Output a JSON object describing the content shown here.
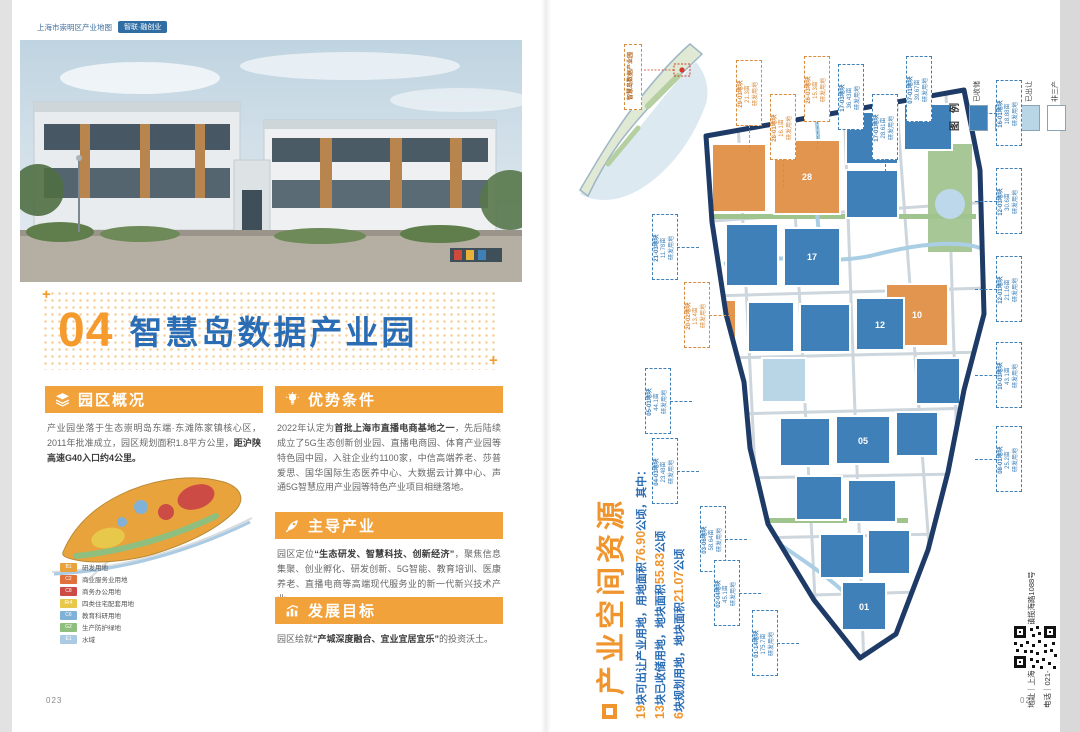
{
  "header": {
    "doc_title": "上海市崇明区产业地图",
    "tag": "智联·融创业"
  },
  "page_title": {
    "number": "04",
    "text": "智慧岛数据产业园"
  },
  "sections": {
    "overview": {
      "heading": "园区概况",
      "body_1": "产业园坐落于生态崇明岛东端·东滩陈家镇核心区，2011年批准成立，园区规划面积1.8平方公里，",
      "body_bold": "距沪陕高速G40入口约4公里。"
    },
    "advantages": {
      "heading": "优势条件",
      "body_1": "2022年认定为",
      "body_bold": "首批上海市直播电商基地之一",
      "body_2": "，先后陆续成立了5G生态创新创业园、直播电商园、体育产业园等特色园中园，入驻企业约1100家，中信高端养老、莎普爱思、国华国际生态医养中心、大数据云计算中心、声通5G智慧应用产业园等特色产业项目相继落地。"
    },
    "industries": {
      "heading": "主导产业",
      "body_1": "园区定位",
      "body_bold": "“生态研发、智慧科技、创新经济”",
      "body_2": "，聚焦信息集聚、创业孵化、研发创新、5G智能、教育培训、医康养老、直播电商等高端现代服务业的新一代新兴技术产业。"
    },
    "goals": {
      "heading": "发展目标",
      "body_1": "园区绘就",
      "body_bold": "“产城深度融合、宜业宜居宜乐”",
      "body_2": "的投资沃土。"
    }
  },
  "zoning_legend": {
    "items": [
      {
        "code": "B1",
        "label": "研发用地",
        "color": "#e8a33d"
      },
      {
        "code": "C2",
        "label": "商业服务业用地",
        "color": "#e2703a"
      },
      {
        "code": "C8",
        "label": "商务办公用地",
        "color": "#cc4b44"
      },
      {
        "code": "Rr4",
        "label": "四类住宅配套用地",
        "color": "#e8c84a"
      },
      {
        "code": "C6",
        "label": "教育科研用地",
        "color": "#7fb2d6"
      },
      {
        "code": "G2",
        "label": "生产防护绿地",
        "color": "#8fbf7f"
      },
      {
        "code": "E1",
        "label": "水域",
        "color": "#aacbe3"
      }
    ]
  },
  "right_page": {
    "vertical_title": "产业空间资源",
    "stats": [
      {
        "n1": "19",
        "t1": "块可出让产业用地，用地面积",
        "n2": "76.90",
        "t2": "公顷，其中："
      },
      {
        "n1": "13",
        "t1": "块已收储用地，地块面积",
        "n2": "55.83",
        "t2": "公顷"
      },
      {
        "n1": "6",
        "t1": "块规划用地，地块面积",
        "n2": "21.07",
        "t2": "公顷"
      }
    ],
    "map_legend": {
      "title": "图例",
      "items": [
        {
          "label": "已收储",
          "color": "#3f80b8"
        },
        {
          "label": "规划",
          "color": "#e2954e"
        },
        {
          "label": "已出让",
          "color": "#b9d6e6"
        },
        {
          "label": "非三产",
          "color": "#ffffff"
        }
      ]
    },
    "inset_label": "智慧岛数据产业园",
    "contact": {
      "address": "地址｜上海市崇明区陈家镇揽海路1088号",
      "phone": "电话｜021-59470082"
    },
    "callouts": [
      {
        "code": "29-03地块",
        "area": "21.3亩",
        "use": "研发用地"
      },
      {
        "code": "28-01地块",
        "area": "16.1亩",
        "use": "研发用地"
      },
      {
        "code": "26-03地块",
        "area": "15.3亩",
        "use": "研发用地"
      },
      {
        "code": "17-03地块",
        "area": "36.43亩",
        "use": "研发用地"
      },
      {
        "code": "17-01地块",
        "area": "28.61亩",
        "use": "研发用地"
      },
      {
        "code": "07-01地块",
        "area": "39.67亩",
        "use": "研发用地"
      },
      {
        "code": "16-01地块",
        "area": "18.88亩",
        "use": "研发用地"
      },
      {
        "code": "12-03地块",
        "area": "30.6亩",
        "use": "研发用地"
      },
      {
        "code": "12-01地块",
        "area": "21.16亩",
        "use": "研发用地"
      },
      {
        "code": "10-03地块",
        "area": "43.1亩",
        "use": "研发用地"
      },
      {
        "code": "08-01地块",
        "area": "25.2亩",
        "use": "研发用地"
      },
      {
        "code": "21-03地块",
        "area": "11.78亩",
        "use": "研发用地"
      },
      {
        "code": "20-02地块",
        "area": "13.4亩",
        "use": "研发用地"
      },
      {
        "code": "05-01地块",
        "area": "44.1亩",
        "use": "研发用地"
      },
      {
        "code": "04-03地块",
        "area": "23.48亩",
        "use": "研发用地"
      },
      {
        "code": "03-06地块",
        "area": "58.64亩",
        "use": "研发用地"
      },
      {
        "code": "02-04地块",
        "area": "45.1亩",
        "use": "研发用地"
      },
      {
        "code": "01-14地块",
        "area": "175.7亩",
        "use": "研发用地"
      }
    ],
    "parcel_labels": [
      "28",
      "17",
      "12",
      "10",
      "05",
      "01"
    ]
  },
  "page_numbers": {
    "left": "023",
    "right": "024"
  },
  "colors": {
    "accent_orange": "#f2a23b",
    "title_blue": "#2a6db5",
    "map_stored_blue": "#3f80b8",
    "map_plan_orange": "#e2954e",
    "map_sold_lightblue": "#b9d6e6",
    "map_border_navy": "#1e3a66"
  }
}
